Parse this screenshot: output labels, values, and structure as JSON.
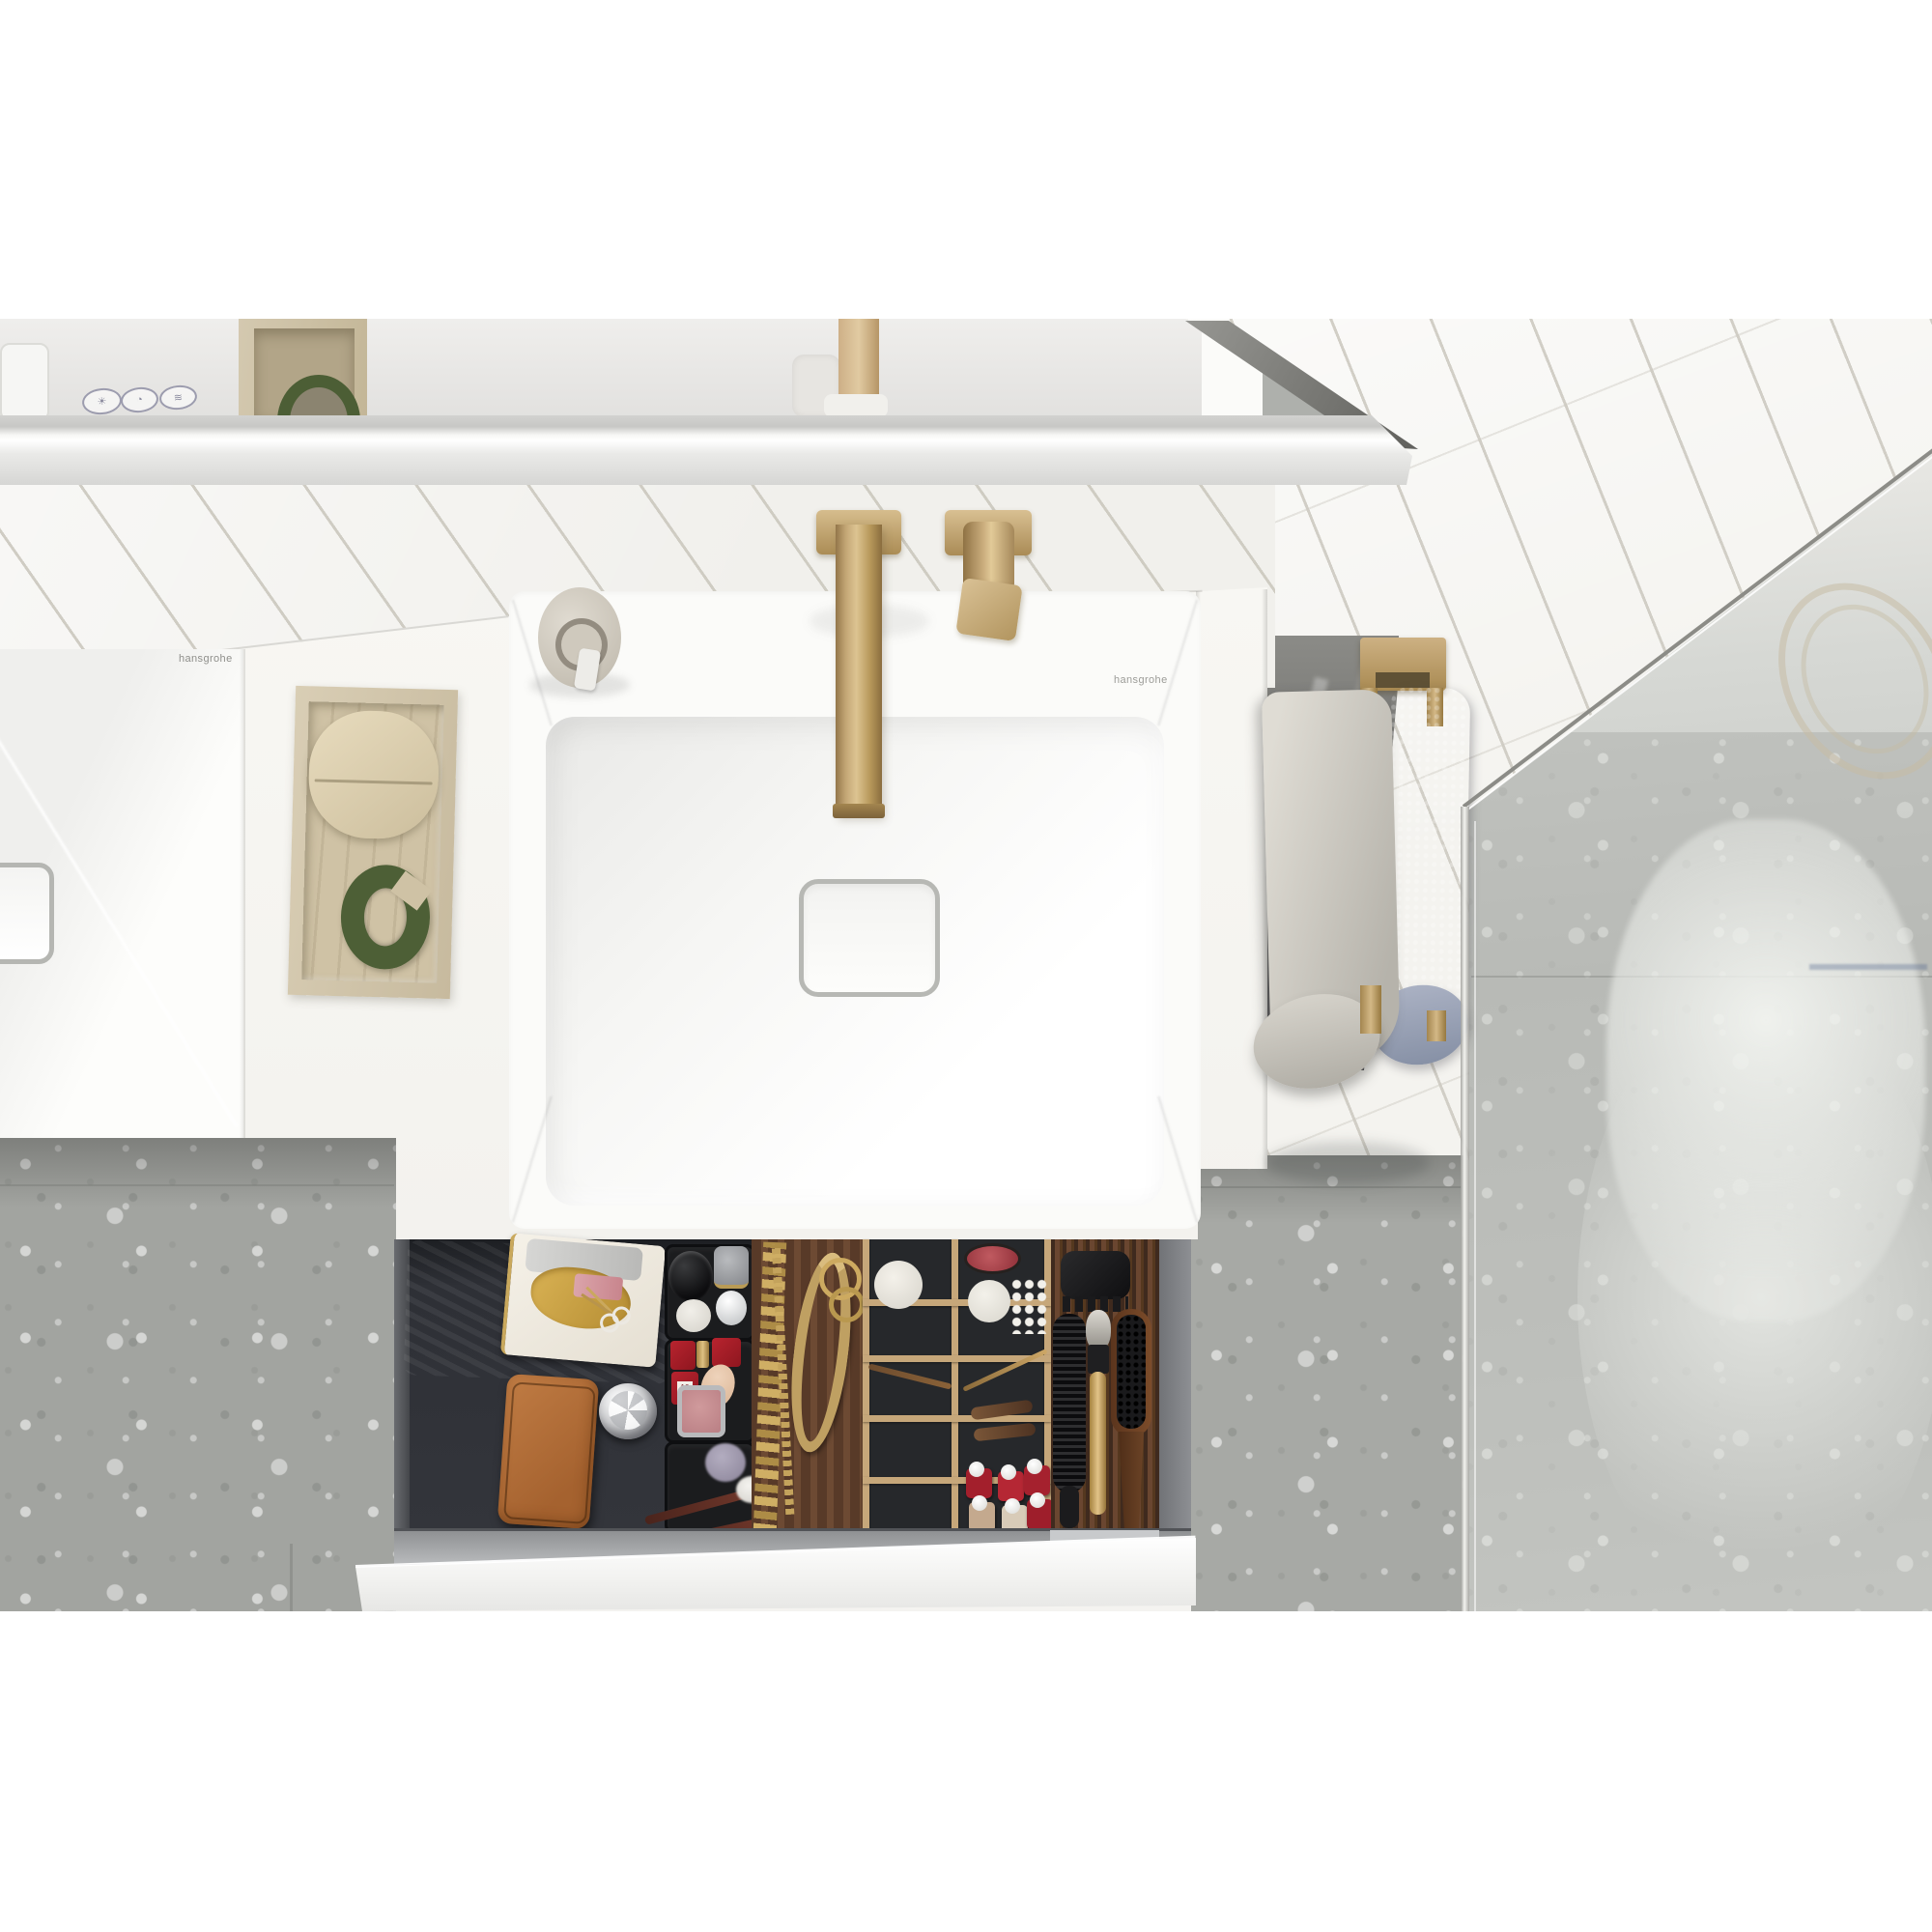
{
  "scene": {
    "type": "photograph",
    "subject": "top-down view of a bathroom vanity with double washbasin, brass wall faucet, open organizer drawer, towel rail and glass shower"
  },
  "brand": {
    "left_basin_logo": "hansgrohe",
    "right_counter_logo": "hansgrohe"
  },
  "mirror_controls": {
    "buttons": [
      {
        "name": "light-control-icon",
        "glyph": "☀"
      },
      {
        "name": "dim-control-icon",
        "glyph": "◔"
      },
      {
        "name": "mirror-heat-control-icon",
        "glyph": "≋"
      }
    ]
  },
  "drawer_contents": [
    "navy-towel",
    "ceramic-tray-with-gold-dish-and-scissors",
    "silver-pouch",
    "cognac-leather-case",
    "crystal-ball",
    "makeup-brushes",
    "black-organizer-trays",
    "red-lipstick-boxes",
    "makeup-sponge",
    "blush-compact",
    "gold-chain-necklace",
    "gold-mesh-necklace",
    "gold-rings",
    "wooden-grid-organizer",
    "red-compact",
    "bath-ball",
    "cotton-swabs",
    "gold-pencil",
    "hair-barrettes",
    "nail-polish-bottles",
    "hair-claw-clip",
    "round-hair-brush",
    "gold-makeup-brush",
    "wooden-paddle-brush"
  ],
  "counter_items": [
    "soap-dispenser",
    "travertine-tray",
    "cream-leather-pouch",
    "green-shagreen-cuff"
  ],
  "fixtures": [
    "wall-mounted-brass-spout",
    "brass-lever-handle",
    "brass-towel-bar",
    "glass-shower-screen"
  ],
  "nail_polish_label": "10",
  "palette": {
    "brass": "#b79766",
    "towel_light": "#cdcac2",
    "towel_blue": "#8e99af",
    "navy_towel": "#243247",
    "orange_case": "#b5713c",
    "green_cuff": "#4d5f36",
    "travertine": "#d2c6ac",
    "walnut": "#5d3c29",
    "oak_frame": "#c6a77a",
    "floor_gray": "#abada9",
    "polish_red": "#a31f2c",
    "tile_white": "#f1f0ec"
  }
}
